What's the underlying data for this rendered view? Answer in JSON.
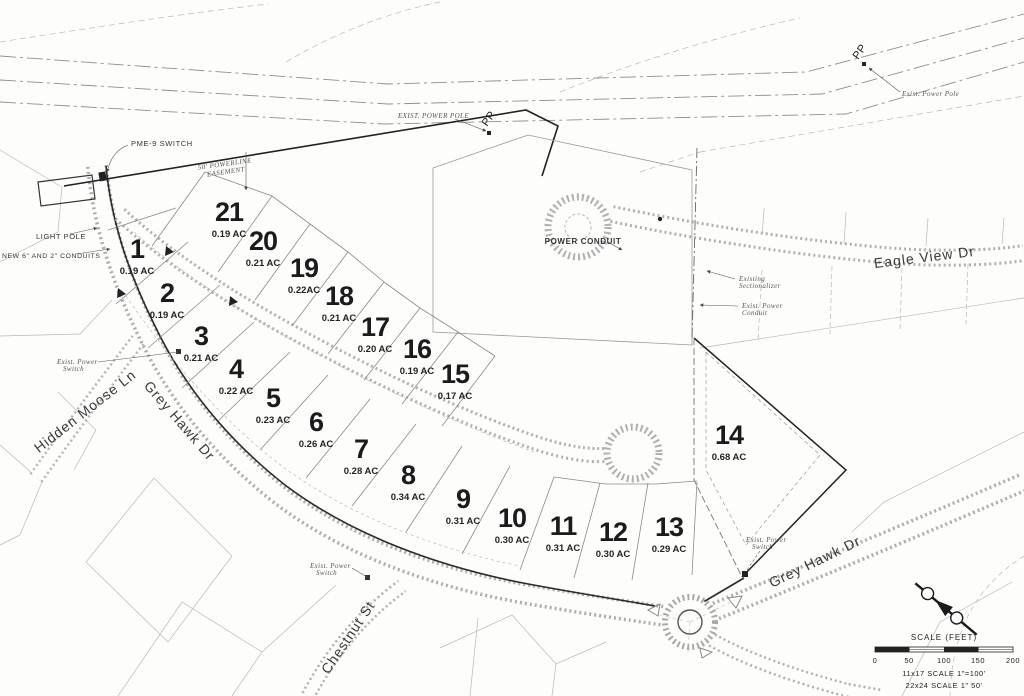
{
  "lots": [
    {
      "number": "1",
      "acreage": "0.19 AC"
    },
    {
      "number": "2",
      "acreage": "0.19 AC"
    },
    {
      "number": "3",
      "acreage": "0.21 AC"
    },
    {
      "number": "4",
      "acreage": "0.22 AC"
    },
    {
      "number": "5",
      "acreage": "0.23 AC"
    },
    {
      "number": "6",
      "acreage": "0.26 AC"
    },
    {
      "number": "7",
      "acreage": "0.28 AC"
    },
    {
      "number": "8",
      "acreage": "0.34 AC"
    },
    {
      "number": "9",
      "acreage": "0.31 AC"
    },
    {
      "number": "10",
      "acreage": "0.30 AC"
    },
    {
      "number": "11",
      "acreage": "0.31 AC"
    },
    {
      "number": "12",
      "acreage": "0.30 AC"
    },
    {
      "number": "13",
      "acreage": "0.29 AC"
    },
    {
      "number": "14",
      "acreage": "0.68 AC"
    },
    {
      "number": "15",
      "acreage": "0.17 AC"
    },
    {
      "number": "16",
      "acreage": "0.19 AC"
    },
    {
      "number": "17",
      "acreage": "0.20 AC"
    },
    {
      "number": "18",
      "acreage": "0.21 AC"
    },
    {
      "number": "19",
      "acreage": "0.22AC"
    },
    {
      "number": "20",
      "acreage": "0.21 AC"
    },
    {
      "number": "21",
      "acreage": "0.19 AC"
    }
  ],
  "streets": {
    "hidden_moose": "Hidden Moose Ln",
    "grey_hawk_left": "Grey Hawk Dr",
    "grey_hawk_right": "Grey Hawk Dr",
    "eagle_view": "Eagle View Dr",
    "chestnut": "Chestnut St"
  },
  "annotations": {
    "pme_switch": "PME-9 SWITCH",
    "light_pole": "LIGHT POLE",
    "new_conduits": "NEW 6\" AND 2\" CONDUITS",
    "exist_power_pole_top": "EXIST. POWER POLE",
    "exist_power_pole_right": "Exist. Power Pole",
    "pp": "PP",
    "powerline_easement_line1": "50' POWERLINE",
    "powerline_easement_line2": "EASEMENT",
    "power_conduit": "POWER CONDUIT",
    "existing_sectionalizer_line1": "Existing",
    "existing_sectionalizer_line2": "Sectionalizer",
    "exist_power_conduit_line1": "Exist. Power",
    "exist_power_conduit_line2": "Conduit",
    "exist_power_switch_line1": "Exist. Power",
    "exist_power_switch_line2": "Switch"
  },
  "scale_block": {
    "title": "SCALE (FEET)",
    "ticks": [
      "0",
      "50",
      "100",
      "150",
      "200"
    ],
    "note1": "11x17 SCALE 1\"=100'",
    "note2": "22x24 SCALE 1\" 50'"
  }
}
